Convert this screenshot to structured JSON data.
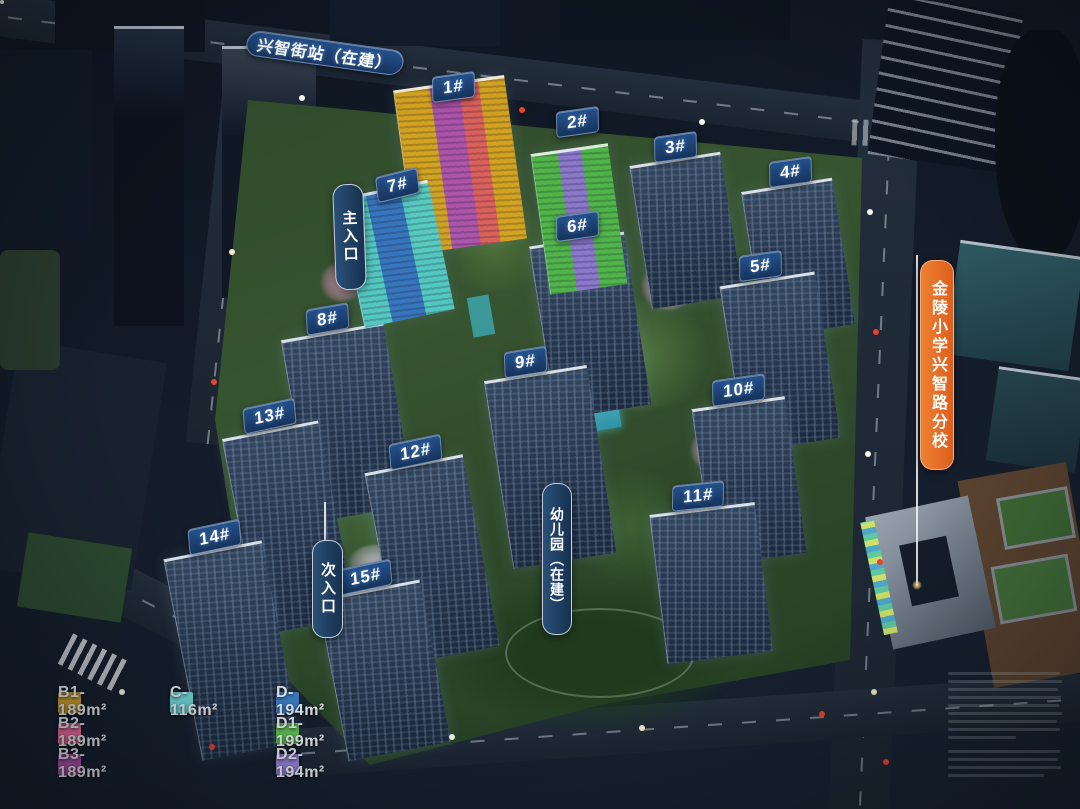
{
  "signs": {
    "metro_station": "兴智街站（在建）",
    "main_entrance": "主入口",
    "secondary_entrance": "次入口",
    "kindergarten": "幼儿园（在建）",
    "school": "金陵小学兴智路分校"
  },
  "buildings": [
    {
      "id": "1",
      "label": "1#"
    },
    {
      "id": "2",
      "label": "2#"
    },
    {
      "id": "3",
      "label": "3#"
    },
    {
      "id": "4",
      "label": "4#"
    },
    {
      "id": "5",
      "label": "5#"
    },
    {
      "id": "6",
      "label": "6#"
    },
    {
      "id": "7",
      "label": "7#"
    },
    {
      "id": "8",
      "label": "8#"
    },
    {
      "id": "9",
      "label": "9#"
    },
    {
      "id": "10",
      "label": "10#"
    },
    {
      "id": "11",
      "label": "11#"
    },
    {
      "id": "12",
      "label": "12#"
    },
    {
      "id": "13",
      "label": "13#"
    },
    {
      "id": "14",
      "label": "14#"
    },
    {
      "id": "15",
      "label": "15#"
    }
  ],
  "legend": {
    "items": [
      {
        "code": "B1",
        "label": "B1-189m²",
        "color": "#d2a22b"
      },
      {
        "code": "B2",
        "label": "B2-189m²",
        "color": "#ee6f9c"
      },
      {
        "code": "B3",
        "label": "B3-189m²",
        "color": "#b351ab"
      },
      {
        "code": "C",
        "label": "C-116m²",
        "color": "#72d8d8"
      },
      {
        "code": "D",
        "label": "D-194m²",
        "color": "#3c7dc4"
      },
      {
        "code": "D1",
        "label": "D1-199m²",
        "color": "#62c456"
      },
      {
        "code": "D2",
        "label": "D2-194m²",
        "color": "#9784d8"
      }
    ]
  },
  "highlight_colors": {
    "tower1_stripes": [
      "#d9a621",
      "#b156ae",
      "#e2635e",
      "#d9a621"
    ],
    "tower2_stripes": [
      "#52b94a",
      "#8f7ad0",
      "#52b94a"
    ],
    "tower7_stripes": [
      "#56cdc6",
      "#3878c2",
      "#56cdc6"
    ],
    "sign_navy": "#16335c",
    "sign_orange": "#e8702b"
  }
}
